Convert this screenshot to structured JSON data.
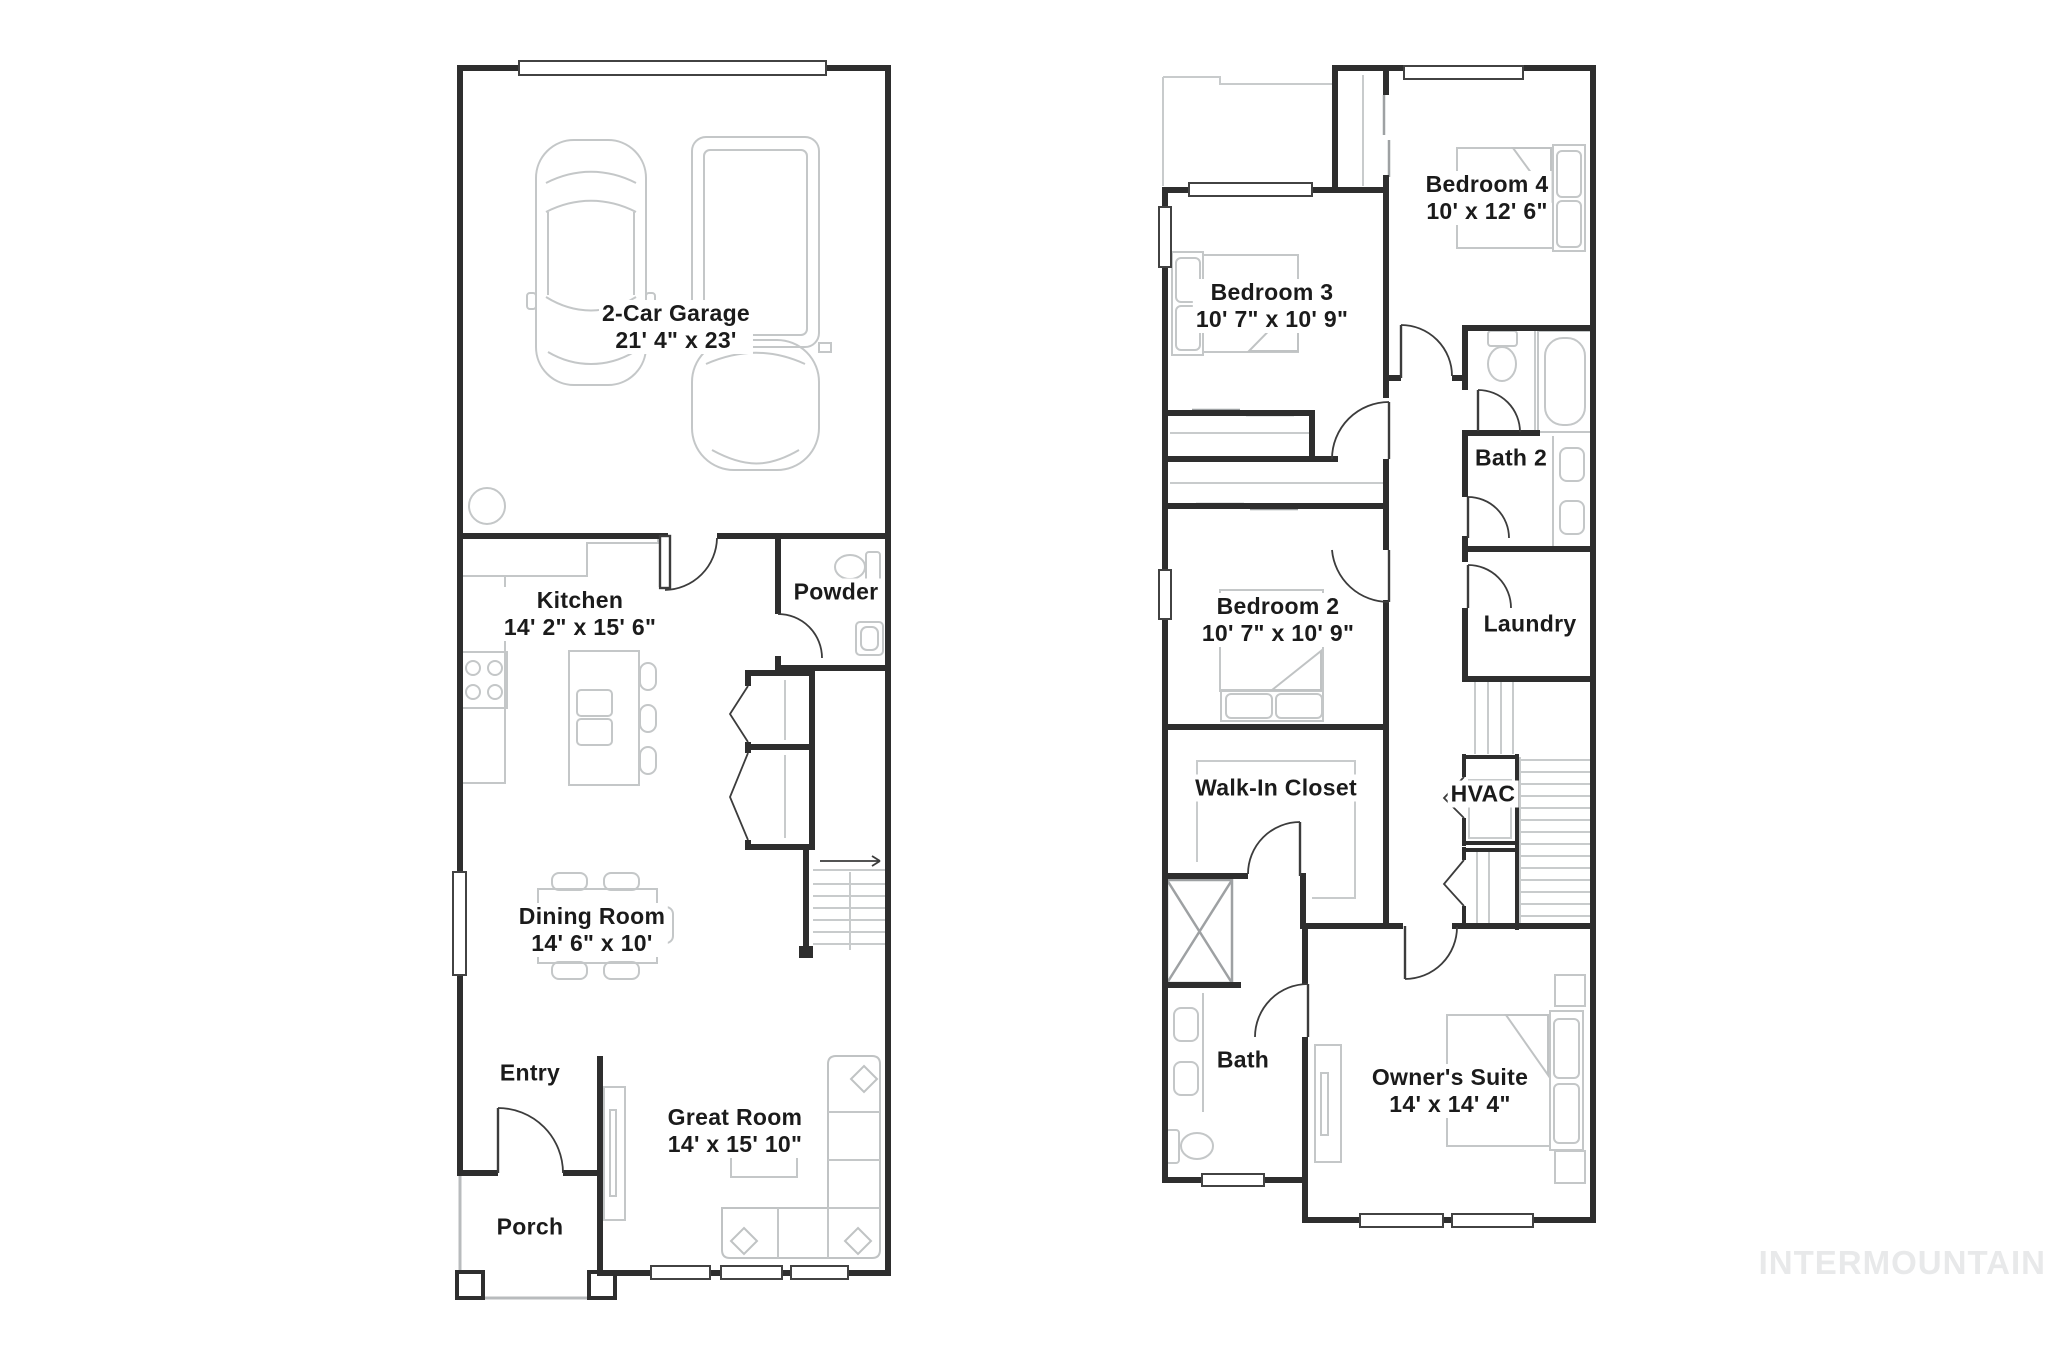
{
  "floor1": {
    "rooms": [
      {
        "id": "garage",
        "name": "2-Car Garage",
        "dims": "21' 4\" x 23'"
      },
      {
        "id": "kitchen",
        "name": "Kitchen",
        "dims": "14' 2\" x 15' 6\""
      },
      {
        "id": "powder",
        "name": "Powder",
        "dims": ""
      },
      {
        "id": "dining",
        "name": "Dining Room",
        "dims": "14' 6\" x 10'"
      },
      {
        "id": "entry",
        "name": "Entry",
        "dims": ""
      },
      {
        "id": "porch",
        "name": "Porch",
        "dims": ""
      },
      {
        "id": "great",
        "name": "Great Room",
        "dims": "14' x 15' 10\""
      }
    ]
  },
  "floor2": {
    "rooms": [
      {
        "id": "bedroom4",
        "name": "Bedroom 4",
        "dims": "10' x 12' 6\""
      },
      {
        "id": "bedroom3",
        "name": "Bedroom 3",
        "dims": "10' 7\" x 10' 9\""
      },
      {
        "id": "bath2",
        "name": "Bath 2",
        "dims": ""
      },
      {
        "id": "bedroom2",
        "name": "Bedroom 2",
        "dims": "10' 7\" x 10' 9\""
      },
      {
        "id": "laundry",
        "name": "Laundry",
        "dims": ""
      },
      {
        "id": "wic",
        "name": "Walk-In Closet",
        "dims": ""
      },
      {
        "id": "hvac",
        "name": "HVAC",
        "dims": ""
      },
      {
        "id": "bath",
        "name": "Bath",
        "dims": ""
      },
      {
        "id": "owners",
        "name": "Owner's Suite",
        "dims": "14' x 14' 4\""
      }
    ]
  },
  "watermark": "INTERMOUNTAIN",
  "colors": {
    "wall": "#2e2e2e",
    "furniture": "#c4c7c8",
    "text": "#1b1b1b",
    "watermark": "#e8e9ea"
  }
}
